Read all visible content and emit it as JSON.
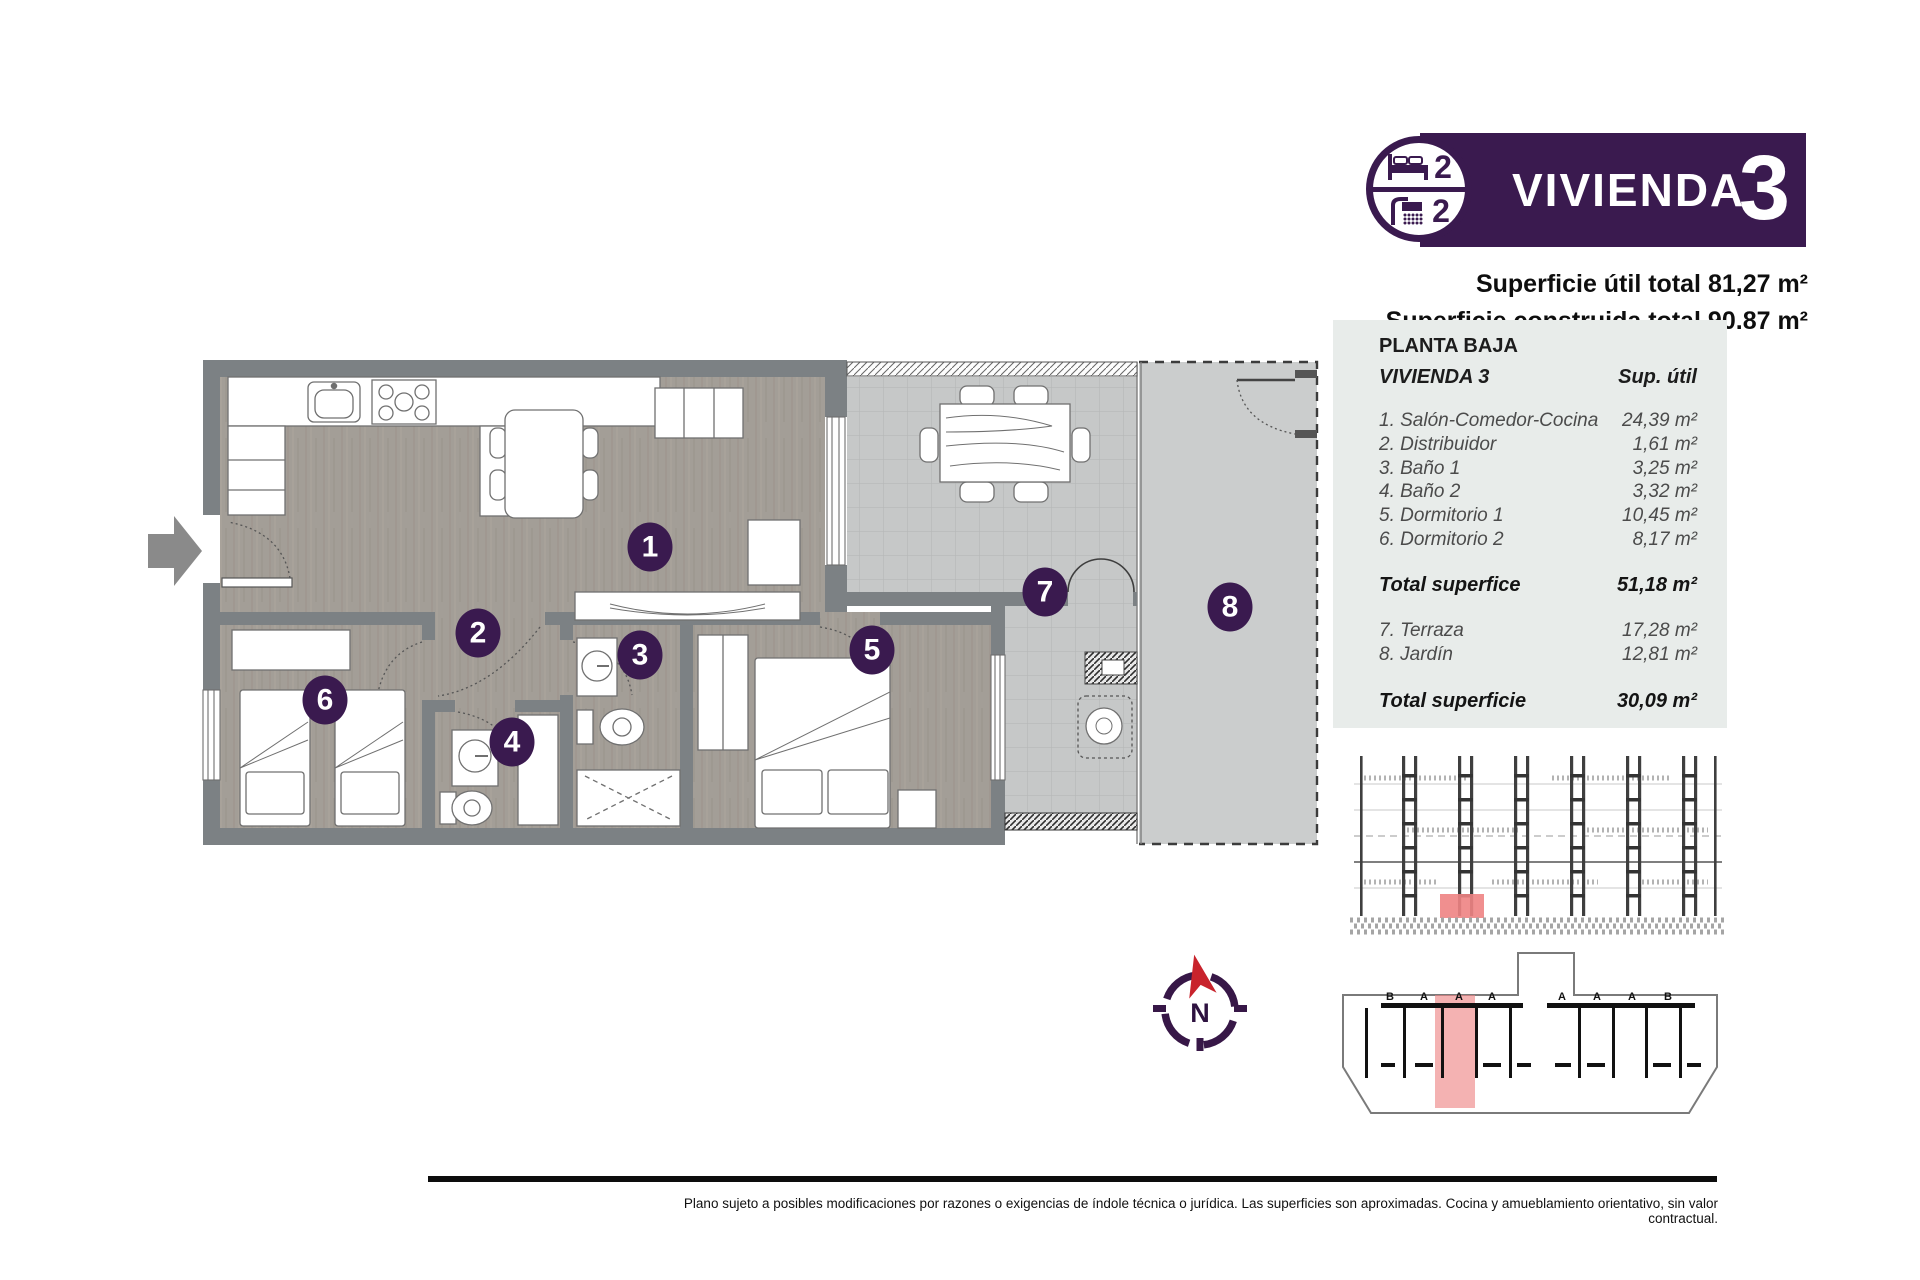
{
  "banner": {
    "title": "VIVIENDA",
    "number": "3",
    "bed_count": "2",
    "bath_count": "2"
  },
  "surface_lines": {
    "util": "Superficie útil total 81,27 m²",
    "construida": "Superficie construida total 90.87 m²"
  },
  "table": {
    "floor_label": "PLANTA BAJA",
    "unit_label": "VIVIENDA 3",
    "col_header": "Sup. útil",
    "rooms": [
      {
        "label": "1. Salón-Comedor-Cocina",
        "value": "24,39 m²"
      },
      {
        "label": "2. Distribuidor",
        "value": "1,61 m²"
      },
      {
        "label": "3. Baño 1",
        "value": "3,25 m²"
      },
      {
        "label": "4. Baño 2",
        "value": "3,32 m²"
      },
      {
        "label": "5. Dormitorio 1",
        "value": "10,45 m²"
      },
      {
        "label": "6. Dormitorio 2",
        "value": "8,17 m²"
      }
    ],
    "total_interior": {
      "label": "Total superfice",
      "value": "51,18 m²"
    },
    "outdoor": [
      {
        "label": "7. Terraza",
        "value": "17,28 m²"
      },
      {
        "label": "8. Jardín",
        "value": "12,81 m²"
      }
    ],
    "total_outdoor": {
      "label": "Total superficie",
      "value": "30,09 m²"
    }
  },
  "plan": {
    "badges": [
      "1",
      "2",
      "3",
      "4",
      "5",
      "6",
      "7",
      "8"
    ]
  },
  "compass": {
    "north_label": "N"
  },
  "site_plan": {
    "unit_labels": [
      "B",
      "A",
      "A",
      "A",
      "A",
      "A",
      "A",
      "B"
    ]
  },
  "footer": {
    "disclaimer": "Plano sujeto a posibles modificaciones por razones o exigencias de índole técnica o jurídica. Las superficies son aproximadas. Cocina y amueblamiento orientativo, sin valor contractual."
  },
  "colors": {
    "brand_purple": "#3a1a4f",
    "highlight_red": "#ee8383",
    "panel_bg": "#e8ecea",
    "wall_gray": "#7c8184"
  }
}
